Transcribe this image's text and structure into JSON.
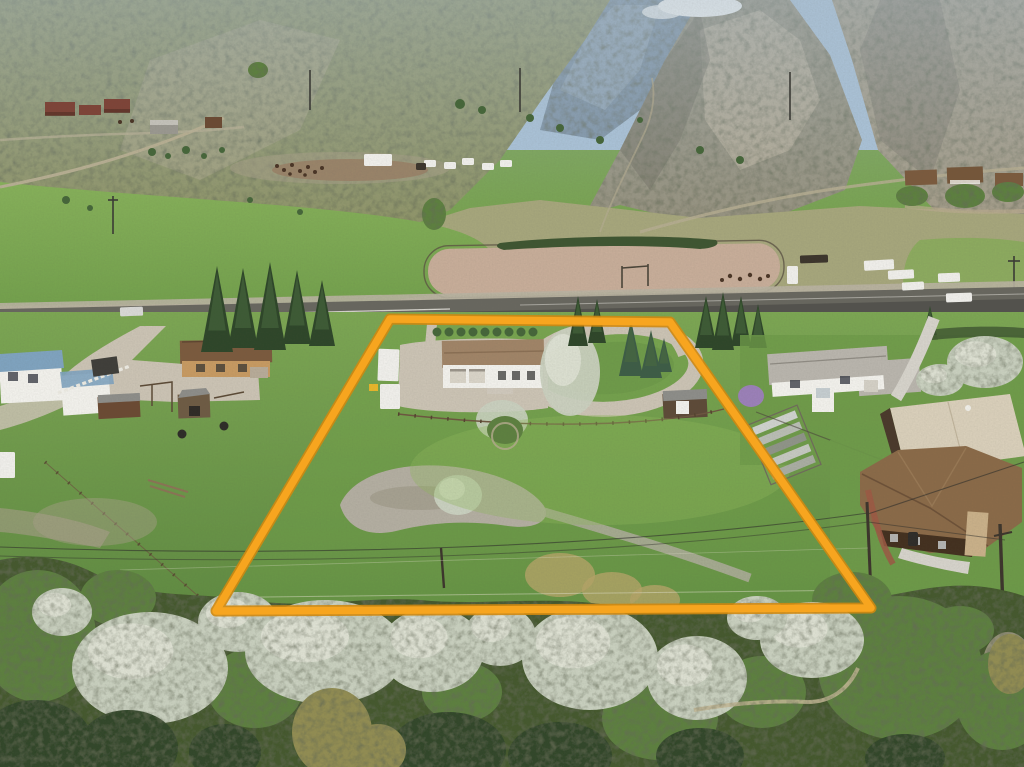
{
  "meta": {
    "title": "Aerial drone photo of rural acreage with orange property-boundary overlay",
    "width": 1024,
    "height": 767
  },
  "palette": {
    "sky": "#a9c2d8",
    "cloud": "#f3f5f4",
    "ridge_blue": "#7e93a6",
    "ridge_blue_light": "#9db0bf",
    "rock": "#96927f",
    "rock_right": "#a49c88",
    "rock_shadow": "#6f6b5f",
    "scree": "#bcb39c",
    "hill_grass": "#8f9468",
    "bench": "#a6a67c",
    "field_bright": "#7fa854",
    "field_right": "#8aab5c",
    "arena_dirt": "#c7ad99",
    "arena_fence": "#5d5444",
    "hedge_dark": "#3e5531",
    "asphalt": "#68675f",
    "asphalt_dark": "#504f4a",
    "road_line": "#e8e6df",
    "shoulder": "#b9b2a2",
    "gravel": "#cbc3b4",
    "concrete": "#d6d3cb",
    "pasture": "#74a34b",
    "pasture_dark": "#5e8840",
    "lawn": "#6e9a49",
    "grass_light": "#8fb65c",
    "rocks": "#b3aea1",
    "reeds": "#b4a468",
    "dirt_patch": "#a89f8a",
    "blossom": "#c9d0bf",
    "blossom_bright": "#e4e7da",
    "tree_green": "#5d8040",
    "tree_dark": "#46663a",
    "conifer": "#31462b",
    "conifer_olive": "#928d52",
    "spruce": "#2e4629",
    "spruce_blue": "#3d5c46",
    "band_base": "#44582f",
    "boundary": "#f7a51f",
    "boundary_edge": "#cf8811",
    "roof_subject": "#a08467",
    "roof_tan_house": "#7b5a3e",
    "roof_gray": "#b9b5ad",
    "roof_cream": "#d9cfba",
    "roof_brown_big": "#8a6a48",
    "roof_blue": "#7fa3bf",
    "roof_shed": "#8d8d89",
    "wall_white": "#f2f1ec",
    "wall_tan": "#c79a62",
    "wall_brown": "#43301f",
    "wall_red": "#7e4438",
    "barn_gray": "#9a9890",
    "shed_brown": "#6b4a33",
    "stone": "#c9b089",
    "brick": "#9c5844",
    "lilac": "#9b80b8",
    "vehicle_white": "#f0efeb",
    "vehicle_silver": "#d9d9d7",
    "equip_yellow": "#e8b62a",
    "wire": "#2f2f2b",
    "pole": "#3c352c",
    "fence_brown": "#6d5640",
    "fence_white": "#eceae2",
    "corral_rust": "#8a5f42",
    "animal_dark": "#4a3526"
  },
  "boundary": {
    "points": "390,319 670,322 871,608 216,611",
    "stroke_width": 7.5,
    "under_width": 11
  },
  "scene": {
    "vehicles": [
      {
        "name": "silver-car-on-highway",
        "x": 120,
        "y": 307,
        "w": 23,
        "h": 9,
        "r": -2,
        "k": "vehicle_silver"
      },
      {
        "name": "white-car-on-highway",
        "x": 946,
        "y": 293,
        "w": 26,
        "h": 9,
        "r": -2,
        "k": "vehicle_white"
      },
      {
        "name": "white-pickup-bench",
        "x": 938,
        "y": 273,
        "w": 22,
        "h": 9,
        "r": -2,
        "k": "vehicle_white"
      },
      {
        "name": "white-pickup-left-edge",
        "x": -5,
        "y": 452,
        "w": 20,
        "h": 26,
        "r": 0,
        "k": "vehicle_white"
      },
      {
        "name": "camper-trailer",
        "x": 378,
        "y": 349,
        "w": 21,
        "h": 32,
        "r": 2,
        "k": "vehicle_white"
      },
      {
        "name": "camper-box",
        "x": 380,
        "y": 384,
        "w": 20,
        "h": 25,
        "r": 0,
        "k": "vehicle_white"
      },
      {
        "name": "semi-trailer-bench",
        "x": 364,
        "y": 154,
        "w": 28,
        "h": 12,
        "r": 0,
        "k": "vehicle_white"
      },
      {
        "name": "horse-trailer-1",
        "x": 864,
        "y": 260,
        "w": 30,
        "h": 10,
        "r": -3,
        "k": "vehicle_white"
      },
      {
        "name": "horse-trailer-2",
        "x": 888,
        "y": 270,
        "w": 26,
        "h": 9,
        "r": -3,
        "k": "vehicle_white"
      },
      {
        "name": "white-truck-arena",
        "x": 902,
        "y": 282,
        "w": 22,
        "h": 8,
        "r": -3,
        "k": "vehicle_white"
      },
      {
        "name": "dark-stock-trailer",
        "x": 800,
        "y": 255,
        "w": 28,
        "h": 8,
        "r": -2,
        "k": "pole"
      },
      {
        "name": "white-tractor",
        "x": 787,
        "y": 266,
        "w": 11,
        "h": 18,
        "r": 0,
        "k": "vehicle_white"
      }
    ],
    "bench_trailers": [
      {
        "name": "trailer",
        "x": 424,
        "y": 160,
        "w": 12,
        "h": 7,
        "r": 0,
        "k": "vehicle_white"
      },
      {
        "name": "trailer",
        "x": 444,
        "y": 162,
        "w": 12,
        "h": 7,
        "r": 0,
        "k": "vehicle_white"
      },
      {
        "name": "trailer",
        "x": 462,
        "y": 158,
        "w": 12,
        "h": 7,
        "r": 0,
        "k": "vehicle_white"
      },
      {
        "name": "trailer",
        "x": 482,
        "y": 163,
        "w": 12,
        "h": 7,
        "r": 0,
        "k": "vehicle_white"
      },
      {
        "name": "trailer",
        "x": 500,
        "y": 160,
        "w": 12,
        "h": 7,
        "r": 0,
        "k": "vehicle_white"
      },
      {
        "name": "dark-trailer",
        "x": 416,
        "y": 163,
        "w": 10,
        "h": 7,
        "r": 0,
        "k": "pole"
      }
    ],
    "trees_blossom": [
      {
        "x": 150,
        "y": 668,
        "rx": 78,
        "ry": 56
      },
      {
        "x": 238,
        "y": 622,
        "rx": 40,
        "ry": 30
      },
      {
        "x": 325,
        "y": 652,
        "rx": 80,
        "ry": 52
      },
      {
        "x": 432,
        "y": 650,
        "rx": 52,
        "ry": 42
      },
      {
        "x": 500,
        "y": 636,
        "rx": 36,
        "ry": 30
      },
      {
        "x": 590,
        "y": 658,
        "rx": 68,
        "ry": 52
      },
      {
        "x": 697,
        "y": 678,
        "rx": 50,
        "ry": 42
      },
      {
        "x": 812,
        "y": 640,
        "rx": 52,
        "ry": 38
      },
      {
        "x": 757,
        "y": 618,
        "rx": 30,
        "ry": 22
      },
      {
        "x": 62,
        "y": 612,
        "rx": 30,
        "ry": 24
      },
      {
        "x": 985,
        "y": 362,
        "rx": 38,
        "ry": 26
      },
      {
        "x": 940,
        "y": 380,
        "rx": 24,
        "ry": 16
      }
    ],
    "trees_green": [
      {
        "x": 38,
        "y": 636,
        "rx": 58,
        "ry": 66
      },
      {
        "x": 118,
        "y": 598,
        "rx": 38,
        "ry": 28
      },
      {
        "x": 255,
        "y": 688,
        "rx": 48,
        "ry": 40
      },
      {
        "x": 462,
        "y": 692,
        "rx": 40,
        "ry": 30
      },
      {
        "x": 660,
        "y": 718,
        "rx": 58,
        "ry": 42
      },
      {
        "x": 762,
        "y": 692,
        "rx": 44,
        "ry": 36
      },
      {
        "x": 900,
        "y": 668,
        "rx": 82,
        "ry": 72
      },
      {
        "x": 1002,
        "y": 700,
        "rx": 46,
        "ry": 50
      },
      {
        "x": 852,
        "y": 600,
        "rx": 40,
        "ry": 28
      },
      {
        "x": 960,
        "y": 630,
        "rx": 34,
        "ry": 24
      },
      {
        "x": 434,
        "y": 214,
        "rx": 12,
        "ry": 16
      },
      {
        "x": 912,
        "y": 196,
        "rx": 16,
        "ry": 10
      },
      {
        "x": 965,
        "y": 196,
        "rx": 20,
        "ry": 12
      },
      {
        "x": 1008,
        "y": 192,
        "rx": 16,
        "ry": 10
      },
      {
        "x": 258,
        "y": 70,
        "rx": 10,
        "ry": 8
      }
    ],
    "conifers": [
      {
        "x": 36,
        "y": 742,
        "rx": 56,
        "ry": 42
      },
      {
        "x": 128,
        "y": 748,
        "rx": 50,
        "ry": 38
      },
      {
        "x": 225,
        "y": 752,
        "rx": 36,
        "ry": 28
      },
      {
        "x": 448,
        "y": 750,
        "rx": 58,
        "ry": 38
      },
      {
        "x": 560,
        "y": 756,
        "rx": 52,
        "ry": 34
      },
      {
        "x": 700,
        "y": 756,
        "rx": 44,
        "ry": 28
      },
      {
        "x": 905,
        "y": 758,
        "rx": 40,
        "ry": 24
      }
    ],
    "conifers_olive": [
      {
        "x": 332,
        "y": 732,
        "rx": 40,
        "ry": 44
      },
      {
        "x": 378,
        "y": 750,
        "rx": 28,
        "ry": 26
      },
      {
        "x": 1010,
        "y": 664,
        "rx": 22,
        "ry": 30
      }
    ],
    "reed_patches": [
      {
        "x": 560,
        "y": 575,
        "rx": 35,
        "ry": 22
      },
      {
        "x": 612,
        "y": 590,
        "rx": 30,
        "ry": 18
      },
      {
        "x": 655,
        "y": 600,
        "rx": 25,
        "ry": 15
      },
      {
        "x": 728,
        "y": 672,
        "rx": 30,
        "ry": 26
      }
    ],
    "spruces_tall": [
      {
        "x": 217,
        "b": 352,
        "h": 86,
        "w": 16
      },
      {
        "x": 243,
        "b": 348,
        "h": 80,
        "w": 15
      },
      {
        "x": 270,
        "b": 350,
        "h": 88,
        "w": 16
      },
      {
        "x": 297,
        "b": 344,
        "h": 74,
        "w": 14
      },
      {
        "x": 322,
        "b": 346,
        "h": 66,
        "w": 13
      }
    ],
    "spruces_small": [
      {
        "x": 578,
        "b": 346,
        "h": 50,
        "w": 10
      },
      {
        "x": 597,
        "b": 343,
        "h": 44,
        "w": 9
      },
      {
        "x": 706,
        "b": 348,
        "h": 52,
        "w": 11
      },
      {
        "x": 723,
        "b": 350,
        "h": 58,
        "w": 11
      },
      {
        "x": 741,
        "b": 346,
        "h": 50,
        "w": 10
      },
      {
        "x": 758,
        "b": 348,
        "h": 44,
        "w": 9
      },
      {
        "x": 930,
        "b": 340,
        "h": 34,
        "w": 8
      }
    ],
    "spruces_blue": [
      {
        "x": 631,
        "b": 376,
        "h": 56,
        "w": 12
      },
      {
        "x": 651,
        "b": 378,
        "h": 48,
        "w": 11
      },
      {
        "x": 664,
        "b": 372,
        "h": 34,
        "w": 8
      }
    ],
    "shrub_row": {
      "x0": 437,
      "x1": 533,
      "step": 12,
      "y": 332,
      "r": 4.5
    },
    "corral_dots": [
      [
        277,
        166,
        2
      ],
      [
        284,
        170,
        2
      ],
      [
        292,
        165,
        2
      ],
      [
        300,
        171,
        2
      ],
      [
        308,
        167,
        2
      ],
      [
        315,
        172,
        2
      ],
      [
        322,
        168,
        2
      ],
      [
        290,
        174,
        1.8
      ],
      [
        305,
        175,
        1.8
      ],
      [
        120,
        122,
        2
      ],
      [
        132,
        121,
        2
      ]
    ],
    "arena_horse_dots": [
      [
        730,
        276,
        2.2
      ],
      [
        740,
        279,
        2.2
      ],
      [
        750,
        275,
        2.2
      ],
      [
        760,
        279,
        2.2
      ],
      [
        768,
        276,
        2
      ],
      [
        722,
        280,
        2
      ]
    ],
    "sage_dots": [
      [
        152,
        152,
        4
      ],
      [
        168,
        156,
        3
      ],
      [
        186,
        150,
        4
      ],
      [
        204,
        156,
        3
      ],
      [
        222,
        150,
        3
      ],
      [
        460,
        104,
        5
      ],
      [
        482,
        110,
        4
      ],
      [
        530,
        118,
        4
      ],
      [
        560,
        128,
        4
      ],
      [
        600,
        140,
        4
      ],
      [
        640,
        120,
        3
      ],
      [
        700,
        150,
        4
      ],
      [
        740,
        160,
        4
      ],
      [
        66,
        200,
        4
      ],
      [
        90,
        208,
        3
      ],
      [
        250,
        200,
        3
      ],
      [
        300,
        212,
        3
      ]
    ]
  }
}
